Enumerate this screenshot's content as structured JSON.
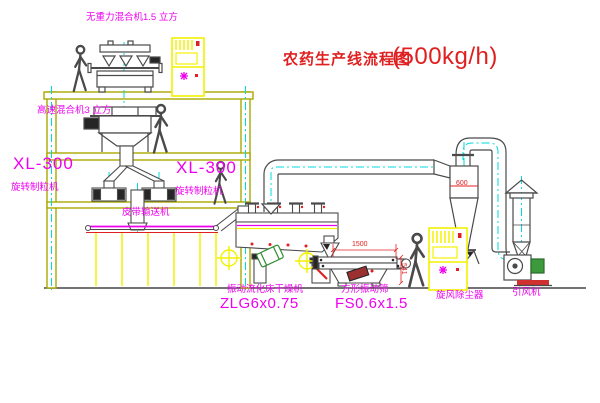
{
  "title": {
    "name": "农药生产线流程图",
    "capacity": "(500kg/h)"
  },
  "labels": {
    "zero_gravity_mixer": "无重力混合机1.5 立方",
    "high_speed_mixer": "高速混合机3 立方",
    "granulator_left_model": "XL-300",
    "granulator_left_name": "旋转制粒机",
    "granulator_center_model": "XL-300",
    "granulator_center_name": "旋转制粒机",
    "belt_conveyor": "皮带输送机",
    "fluid_bed_dryer_name": "振动流化床干燥机",
    "fluid_bed_dryer_model": "ZLG6x0.75",
    "vibrating_screen_name": "方形振动筛",
    "vibrating_screen_model": "FS0.6x1.5",
    "cyclone_name": "旋风除尘器",
    "fan_name": "引风机"
  },
  "dimensions": {
    "screen_length": "1500",
    "screen_height": "541",
    "cyclone_diameter": "600"
  },
  "colors": {
    "label_magenta": "#EE00EE",
    "annotation_red": "#E02020",
    "structure_olive": "#A9A900",
    "equipment_yellow": "#F2F200",
    "centerline_cyan": "#00DADA",
    "line_dark": "#4A4A4A",
    "motor_green": "#3C9A3C"
  },
  "icons": {
    "worker_figure": "walking-person-outline",
    "cabinet_indicator": "magenta-asterisk",
    "crosshair_target": "circle-cross"
  }
}
